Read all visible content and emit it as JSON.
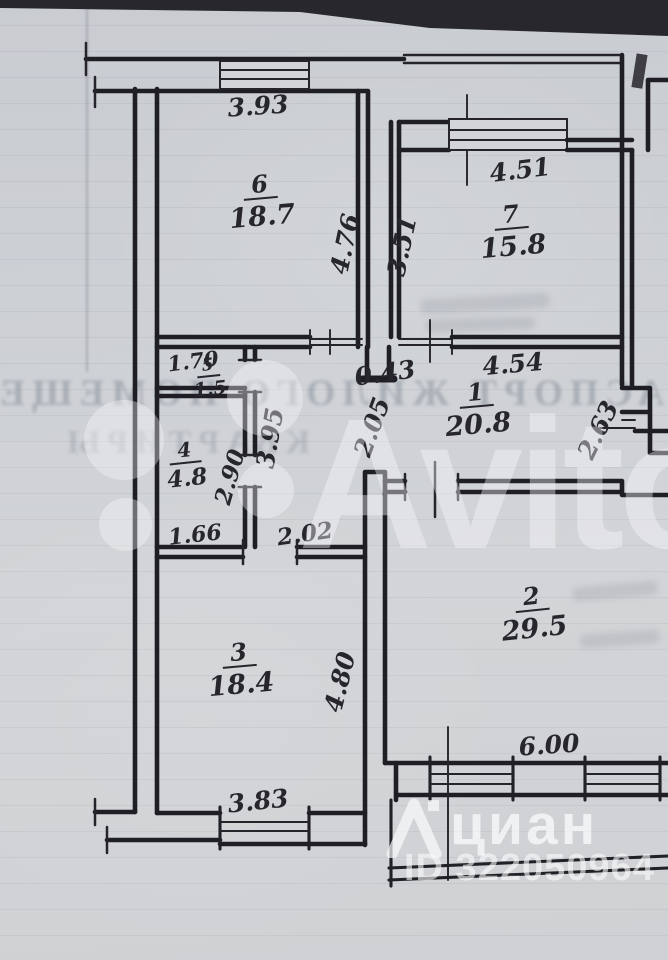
{
  "floorplan": {
    "rooms": {
      "r1": {
        "num": "1",
        "area": "20.8"
      },
      "r2": {
        "num": "2",
        "area": "29.5"
      },
      "r3": {
        "num": "3",
        "area": "18.4"
      },
      "r4": {
        "num": "4",
        "area": "4.8"
      },
      "r5": {
        "num": "5",
        "area": "1.5"
      },
      "r6": {
        "num": "6",
        "area": "18.7"
      },
      "r7": {
        "num": "7",
        "area": "15.8"
      }
    },
    "dims": {
      "w393": "3.93",
      "h476": "4.76",
      "h351": "3.51",
      "w451": "4.51",
      "w170": "1.70",
      "w043": "0.43",
      "w454": "4.54",
      "h263": "2.63",
      "h290": "2.90",
      "h395": "3.95",
      "h205": "2.05",
      "w166": "1.66",
      "w202": "2.02",
      "h480": "4.80",
      "w600": "6.00",
      "w383": "3.83"
    }
  },
  "watermarks": {
    "avito": "Avito",
    "cian": "циан",
    "cian_id": "ID 322050964"
  },
  "bleedthrough": {
    "row1": "ПАСПОРТ ЖИЛОГО ПОМЕЩЕНИ",
    "row2": "КВАРТИРЫ"
  },
  "colors": {
    "paper": "#cdd0d4",
    "ink": "#1e1e24",
    "watermark_white": "#fafafc"
  }
}
